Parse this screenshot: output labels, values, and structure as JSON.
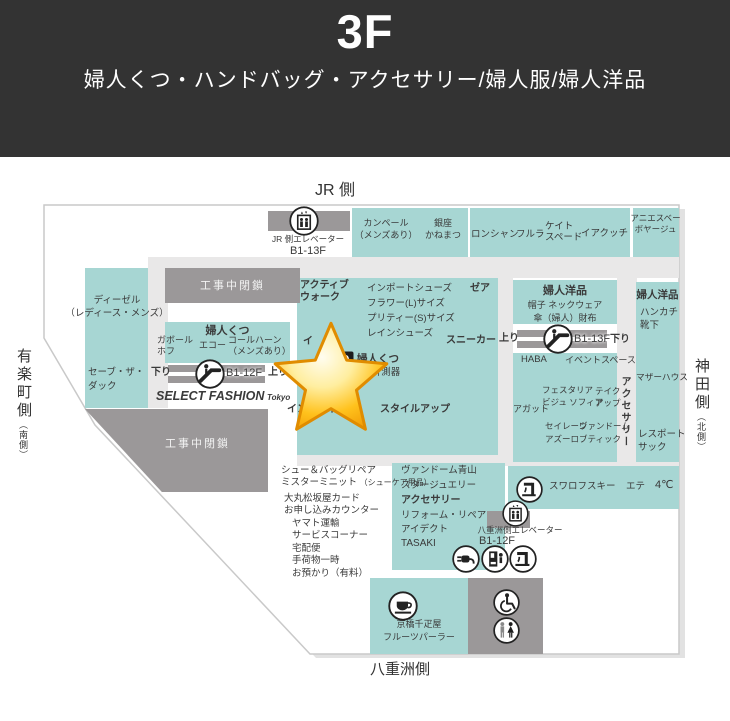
{
  "header": {
    "floor": "3F",
    "subtitle": "婦人くつ・ハンドバッグ・アクセサリー/婦人服/婦人洋品"
  },
  "compass": {
    "top": "JR 側",
    "bottom": "八重洲側",
    "left_main": "有楽町側",
    "left_sub": "（南側）",
    "right_main": "神田側",
    "right_sub": "（北側）"
  },
  "colors": {
    "header_bg": "#333333",
    "zone_teal": "#a7d6d3",
    "closed_gray": "#9b9899",
    "corridor_gray": "#e9e8e8",
    "text": "#3a3a3a",
    "star_gold": "#ffc21d"
  },
  "icons": [
    "elevator-icon",
    "escalator-icon",
    "drinking-fountain-icon",
    "charging-icon",
    "vending-machine-icon",
    "cafe-icon",
    "wheelchair-icon",
    "restroom-icon",
    "foot-measure-icon",
    "star-marker"
  ],
  "labels": {
    "jr_elevator": "JR 側エレベーター",
    "jr_elevator_floors": "B1-13F",
    "construction_top": "工事中閉鎖",
    "construction_bottom": "工事中閉鎖",
    "diesel": "ディーゼル\n（レディース・メンズ）",
    "save_the_duck": "セーブ・ザ・\nダック",
    "womens_shoes_header": "婦人くつ",
    "gabor_hof": "ガボール\nホフ",
    "ecco": "エコー",
    "cole_haan": "コールハーン\n（メンズあり）",
    "esc12_down": "下り",
    "esc12_floors": "B1-12F",
    "esc12_up": "上り",
    "select_fashion": "SELECT FASHION",
    "select_fashion_sub": "Tokyo",
    "camper": "カンペール\n（メンズあり）",
    "ginza_kanematsu": "銀座\nかねまつ",
    "longchamp": "ロンシャン",
    "furla": "フルラ",
    "kate_spade": "ケイト\nスペード",
    "iacucci": "イアクッチ",
    "agnes_b_voyage": "アニエスベー\nボヤージュ",
    "active_walk": "アクティブ\nウォーク",
    "import_shoes_list": "インポートシューズ\nフラワー(L)サイズ\nプリティー(S)サイズ\nレインシューズ",
    "zea": "ゼア",
    "sneaker": "スニーカー",
    "covered_category": "イ",
    "womens_shoes_3d": "婦人くつ",
    "womens_shoes_3d_sub": "3D 計測器",
    "in_business": "インビジネス",
    "style_up": "スタイルアップ",
    "womens_goods_header": "婦人洋品",
    "womens_goods_items": "帽子 ネックウェア\n傘（婦人）財布",
    "esc13_up": "上り",
    "esc13_floors": "B1-13F",
    "esc13_down": "下り",
    "haba": "HABA",
    "event_space": "イベントスペース",
    "festaria": "フェスタリア\nビジュ ソフィア",
    "take_up": "テイク\nアップ",
    "agete": "アガット",
    "sirena_azzurro": "セイレーン\nアズーロ",
    "vendome_boutique": "ヴァンドーム\nブティック",
    "accessory_vertical": "アクセサリー",
    "womens_goods_right": "婦人洋品",
    "womens_goods_right_items": "ハンカチ\n靴下",
    "mother_house": "マザーハウス",
    "lesportsac": "レスポート\nサック",
    "swarovski": "スワロフスキー",
    "ete": "エテ",
    "yondoshi": "4℃",
    "shoe_bag_repair": "シュー＆バッグリペア",
    "mister_minit": "ミスターミニット",
    "mister_minit_sub": "（シューケア用品）",
    "daimaru_card": "大丸松坂屋カード\nお申し込みカウンター",
    "yamato_services": "ヤマト運輸\nサービスコーナー\n宅配便\n手荷物一時\nお預かり（有料）",
    "vendome_aoyama": "ヴァンドーム青山\nスタージュエリー",
    "accessory_bold": "アクセサリー",
    "reform_repair": "リフォーム・リペア\nアイデクト",
    "tasaki": "TASAKI",
    "yaesu_elevator": "八重洲側エレベーター",
    "yaesu_elevator_floors": "B1-12F",
    "senbikiya": "京橋千疋屋\nフルーツパーラー"
  }
}
